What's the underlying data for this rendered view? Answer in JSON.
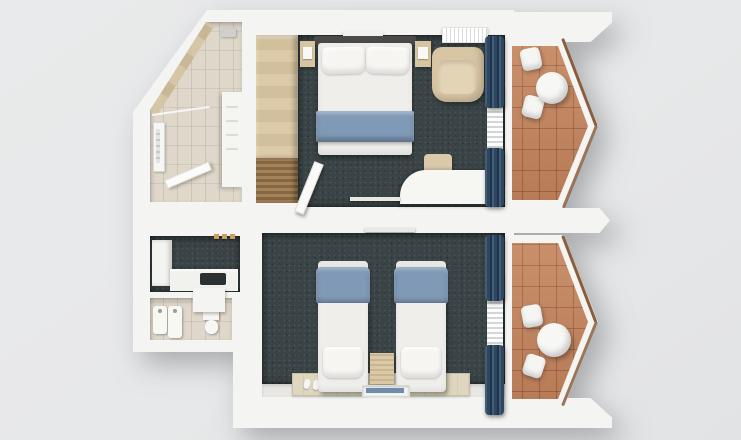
{
  "scene": {
    "type": "3d-floorplan-top-view",
    "text_content": "none",
    "units": [
      {
        "name": "upper-room",
        "rooms": [
          {
            "name": "bathroom",
            "floor": "beige-tile",
            "fixtures": [
              "shower-set",
              "glass-partition",
              "towel-rail",
              "vanity-shelves",
              "open-door"
            ]
          },
          {
            "name": "bedroom",
            "floor": "dark-carpet",
            "furniture": [
              "double-bed",
              "headboard",
              "two-pillows",
              "blue-bed-runner",
              "nightstand-left",
              "nightstand-right",
              "wardrobe",
              "louvered-bench",
              "armchair",
              "desk",
              "stool",
              "wall-tv",
              "air-conditioner",
              "wall-shelf",
              "blue-curtains",
              "sheer-curtain",
              "entry-door"
            ]
          },
          {
            "name": "balcony",
            "floor": "terracotta-tile",
            "furniture": [
              "round-table",
              "chair",
              "chair"
            ],
            "shape": "pointed-hexagon"
          }
        ]
      },
      {
        "name": "lower-room",
        "rooms": [
          {
            "name": "entry-hall",
            "floor": "dark-carpet",
            "furniture": [
              "white-cabinet",
              "counter",
              "dark-hob-sink",
              "wall-hooks"
            ]
          },
          {
            "name": "bathroom",
            "floor": "beige-tile",
            "fixtures": [
              "washbasin",
              "bidet",
              "toilet",
              "wall-stub"
            ]
          },
          {
            "name": "bedroom",
            "floor": "dark-carpet",
            "furniture": [
              "single-bed-left",
              "single-bed-right",
              "blue-blankets",
              "pillows",
              "middle-nightstand",
              "rug",
              "slippers",
              "wall-tv",
              "low-window",
              "blue-curtains",
              "sheer-curtain"
            ]
          },
          {
            "name": "balcony",
            "floor": "terracotta-tile",
            "furniture": [
              "round-table",
              "chair",
              "chair"
            ],
            "shape": "pointed-hexagon"
          }
        ]
      }
    ]
  },
  "colors": {
    "background": "#e9eaeb",
    "wall": "#f4f4f2",
    "carpet": "#3a4446",
    "bathroom_tile": "#ded7ca",
    "balcony_tile": "#c5845c",
    "rail_wood": "#8a5e3c",
    "wood_light": "#d7c4a0",
    "wood_dark": "#97774f",
    "bed_white": "#efeeeb",
    "bed_blue": "#7f99b6",
    "curtain_blue": "#34506c",
    "armchair": "#d8c5a4",
    "rug": "#ded6bf",
    "headboard": "#4b4a48",
    "window_blue": "#6f8caa"
  }
}
